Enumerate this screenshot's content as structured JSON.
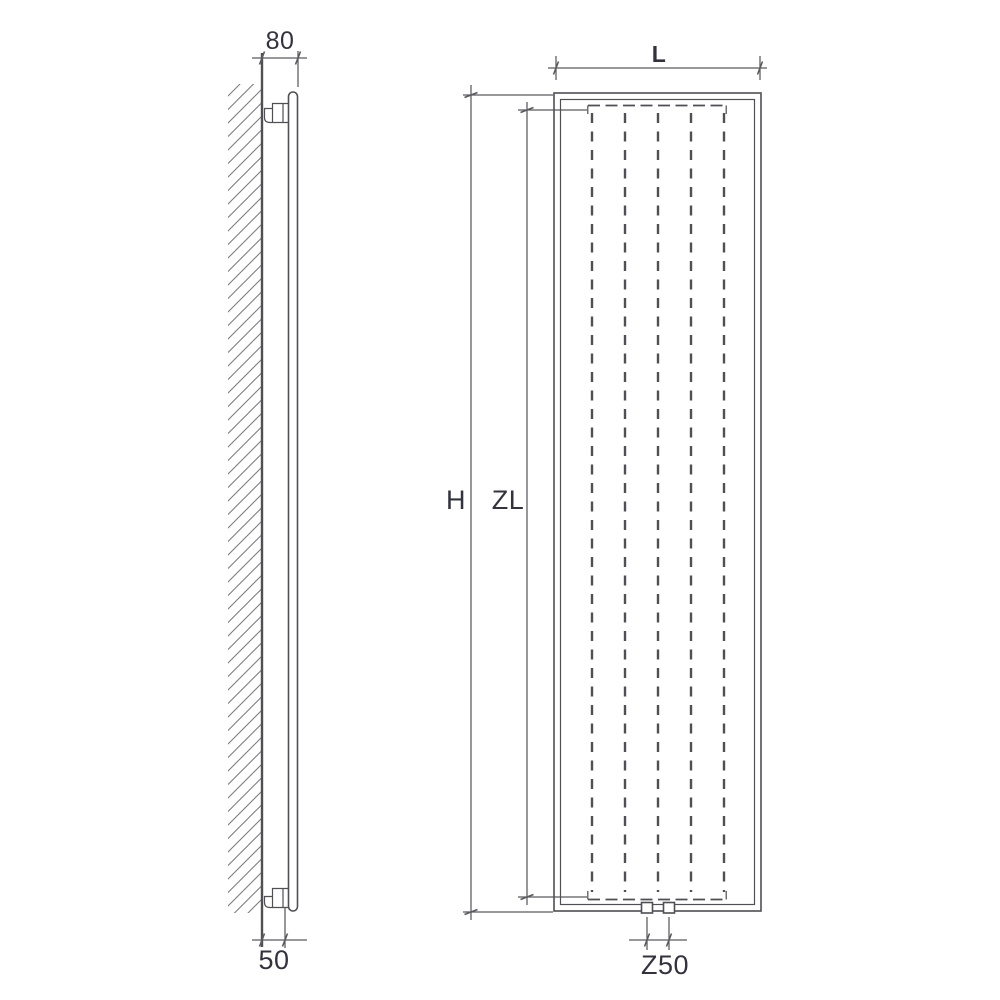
{
  "drawing_type": "radiator-technical-drawing",
  "colors": {
    "line_color": "#4f4f54",
    "dim_color": "#5a5a5f",
    "text_color": "#33333e",
    "hatch_color": "#7d7d82",
    "bg_color": "#ffffff"
  },
  "side_view": {
    "dimensions": {
      "wall_to_front_top": "80",
      "wall_to_bracket_bottom": "50"
    }
  },
  "front_view": {
    "dimensions": {
      "width": "L",
      "overall_height": "H",
      "element_height": "ZL",
      "connection_spacing": "Z50"
    }
  }
}
